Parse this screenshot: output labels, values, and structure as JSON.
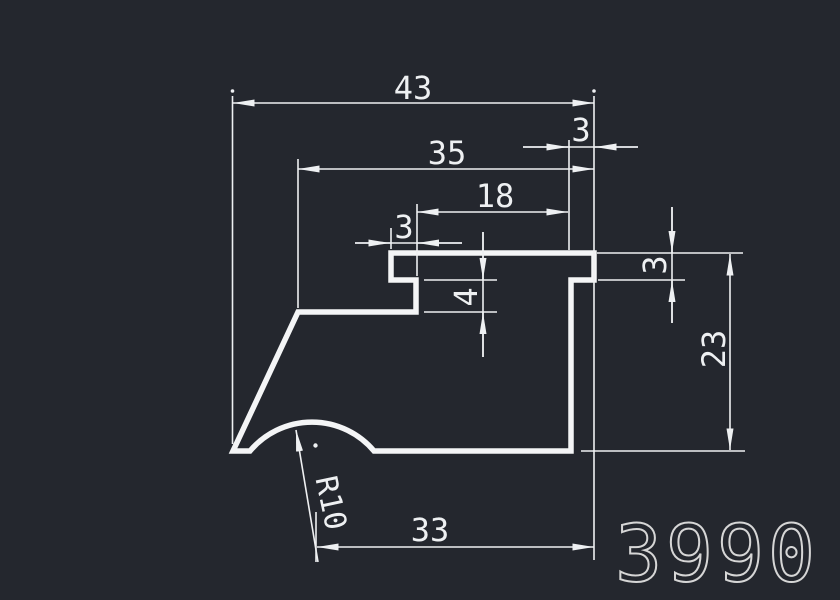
{
  "canvas": {
    "background_color": "#24272e",
    "line_color": "#eef0f2",
    "part_number_color": "#d6d6d6"
  },
  "part_number": "3990",
  "dims": {
    "overall_width": "43",
    "upper_width": "35",
    "pocket_width": "18",
    "flange_step_width": "3",
    "right_notch_width": "3",
    "step_depth": "4",
    "right_notch_depth": "3",
    "right_height": "23",
    "bottom_width": "33",
    "bottom_arc_radius": "R10"
  }
}
